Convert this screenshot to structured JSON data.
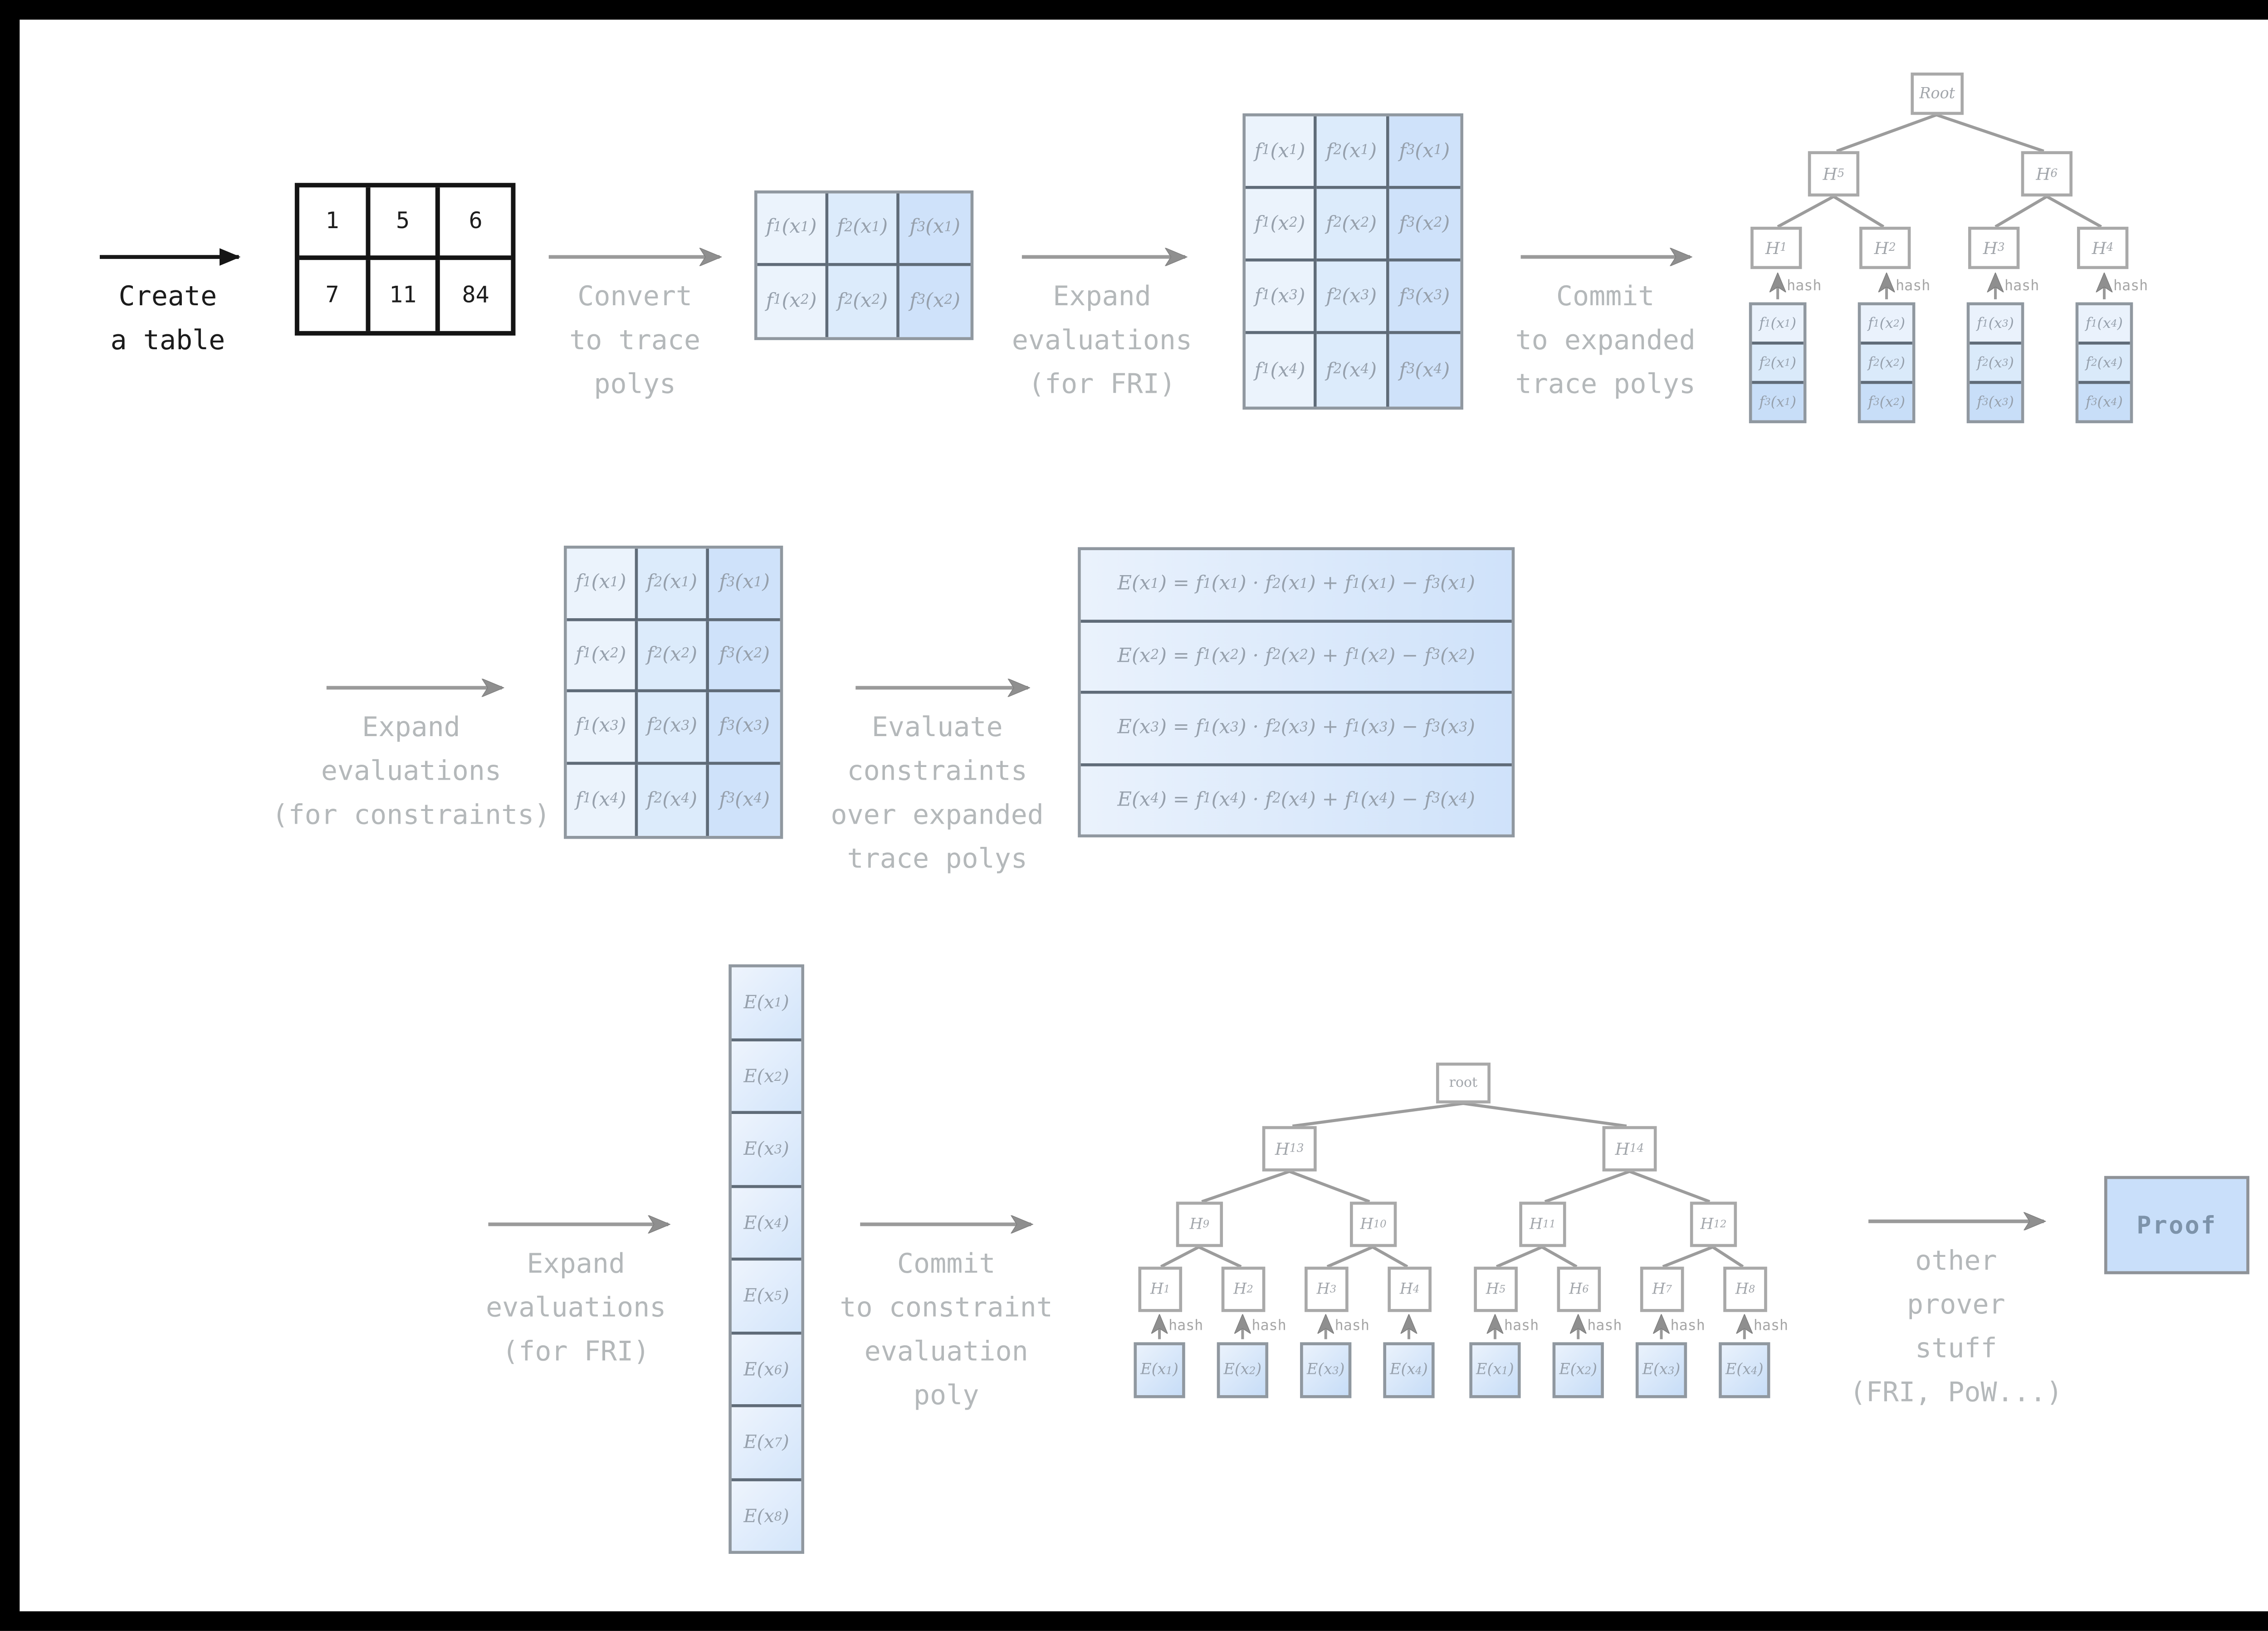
{
  "steps": [
    "Create\na table",
    "Convert\nto trace\npolys",
    "Expand\nevaluations\n(for FRI)",
    "Commit\nto expanded\ntrace polys",
    "Expand\nevaluations\n(for constraints)",
    "Evaluate\nconstraints\nover expanded\ntrace polys",
    "Expand\nevaluations\n(for FRI)",
    "Commit\nto constraint\nevaluation\npoly",
    "other\nprover\nstuff\n(FRI, PoW...)"
  ],
  "labels": {
    "hash": "hash",
    "proof": "Proof"
  },
  "input_table": {
    "rows": [
      [
        "1",
        "5",
        "6"
      ],
      [
        "7",
        "11",
        "84"
      ]
    ]
  },
  "trace_small": {
    "rows": [
      [
        "f_1(x_1)",
        "f_2(x_1)",
        "f_3(x_1)"
      ],
      [
        "f_1(x_2)",
        "f_2(x_2)",
        "f_3(x_2)"
      ]
    ]
  },
  "trace_expanded": {
    "rows": [
      [
        "f_1(x_1)",
        "f_2(x_1)",
        "f_3(x_1)"
      ],
      [
        "f_1(x_2)",
        "f_2(x_2)",
        "f_3(x_2)"
      ],
      [
        "f_1(x_3)",
        "f_2(x_3)",
        "f_3(x_3)"
      ],
      [
        "f_1(x_4)",
        "f_2(x_4)",
        "f_3(x_4)"
      ]
    ]
  },
  "constraints": {
    "rows": [
      "E(x_1) = f_1(x_1) · f_2(x_1) + f_1(x_1) − f_3(x_1)",
      "E(x_2) = f_1(x_2) · f_2(x_2) + f_1(x_2) − f_3(x_2)",
      "E(x_3) = f_1(x_3) · f_2(x_3) + f_1(x_3) − f_3(x_3)",
      "E(x_4) = f_1(x_4) · f_2(x_4) + f_1(x_4) − f_3(x_4)"
    ]
  },
  "e_column": {
    "cells": [
      "E(x_1)",
      "E(x_2)",
      "E(x_3)",
      "E(x_4)",
      "E(x_5)",
      "E(x_6)",
      "E(x_7)",
      "E(x_8)"
    ]
  },
  "top_tree": {
    "root": "Root",
    "level1": [
      "H_5",
      "H_6"
    ],
    "level2": [
      "H_1",
      "H_2",
      "H_3",
      "H_4"
    ],
    "leaf_stacks": [
      [
        "f_1(x_1)",
        "f_2(x_1)",
        "f_3(x_1)"
      ],
      [
        "f_1(x_2)",
        "f_2(x_2)",
        "f_3(x_2)"
      ],
      [
        "f_1(x_3)",
        "f_2(x_3)",
        "f_3(x_3)"
      ],
      [
        "f_1(x_4)",
        "f_2(x_4)",
        "f_3(x_4)"
      ]
    ]
  },
  "bottom_tree": {
    "root": "root",
    "level1": [
      "H_13",
      "H_14"
    ],
    "level2": [
      "H_9",
      "H_10",
      "H_11",
      "H_12"
    ],
    "level3": [
      "H_1",
      "H_2",
      "H_3",
      "H_4",
      "H_5",
      "H_6",
      "H_7",
      "H_8"
    ],
    "leaves": [
      "E(x_1)",
      "E(x_2)",
      "E(x_3)",
      "E(x_4)",
      "E(x_1)",
      "E(x_2)",
      "E(x_3)",
      "E(x_4)"
    ]
  },
  "colors": {
    "cell_blue_light": "#ebf3fc",
    "cell_blue_mid": "#dcebfb",
    "cell_blue_dark": "#cfe2fa",
    "grid_line": "#5f6b78",
    "table_border": "#9098a0",
    "node_border": "#a9a9a9",
    "arrow_gray": "#9a9a9a",
    "label_gray": "#b4b8ba",
    "math_gray": "#96a0ac",
    "proof_fill": "#c9dffa",
    "proof_text": "#7d93aa",
    "ink_black": "#161616"
  }
}
